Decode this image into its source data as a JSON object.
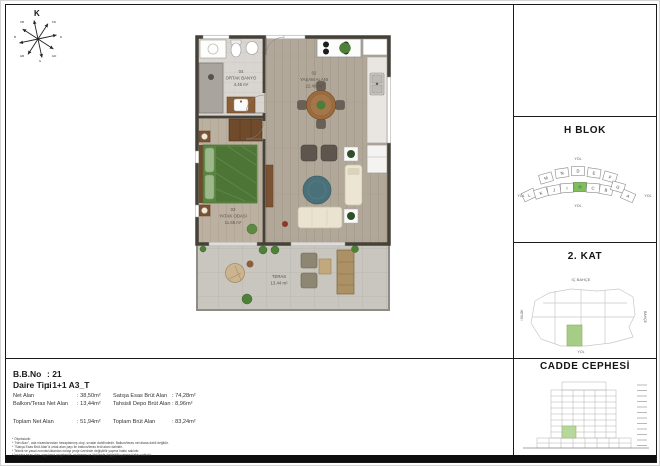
{
  "colors": {
    "site_green": "#7fbf5b",
    "kat_green": "#a6cd86",
    "facade_green": "#b7d79b",
    "bed_green": "#4c7536",
    "wall": "#454139"
  },
  "compass": {
    "north": "K",
    "dirs": {
      "kd": "KD",
      "d": "D",
      "gd": "GD",
      "g": "G",
      "gb": "GB",
      "b": "B",
      "kb": "KB"
    }
  },
  "plan": {
    "rooms": {
      "bathroom": {
        "no": "04",
        "name": "ORTAK BANYO",
        "area": "4.45 m²"
      },
      "living": {
        "no": "02",
        "name": "YAŞAM ALANI",
        "area": "22.40 m²"
      },
      "bedroom": {
        "no": "03",
        "name": "YATAK ODASI",
        "area": "11.65 m²"
      },
      "terrace": {
        "name": "TERAS",
        "area": "13.44 m²"
      }
    }
  },
  "sidebar": {
    "hblok": {
      "title": "H BLOK",
      "road": "YOL",
      "blocks": [
        {
          "label": "M"
        },
        {
          "label": "N"
        },
        {
          "label": "D"
        },
        {
          "label": "E"
        },
        {
          "label": "F"
        },
        {
          "label": "L"
        },
        {
          "label": "K"
        },
        {
          "label": "J"
        },
        {
          "label": "I"
        },
        {
          "label": "H"
        },
        {
          "label": "C"
        },
        {
          "label": "B"
        },
        {
          "label": "G"
        },
        {
          "label": "A"
        }
      ]
    },
    "kat": {
      "title": "2. KAT",
      "top": "İÇ BAHÇE",
      "left": "I BLOK",
      "right": "BAHÇE",
      "bottom": "YOL"
    },
    "facade": {
      "title": "CADDE CEPHESİ"
    }
  },
  "info": {
    "bbno": {
      "label": "B.B.No",
      "value": ": 21"
    },
    "daire": {
      "label": "Daire Tipi",
      "value": ": 1+1 A3_T"
    },
    "rows": [
      {
        "l1": "Net Alan",
        "v1": ": 38,50m²",
        "l2": "Satışa Esas Brüt Alan",
        "v2": ": 74,28m²"
      },
      {
        "l1": "Balkon/Teras Net Alan",
        "v1": ": 13,44m²",
        "l2": "Tahsisli Depo Brüt Alan",
        "v2": ": 8,96m²"
      }
    ],
    "totals": {
      "l1": "Toplam Net Alan",
      "v1": ": 51,94m²",
      "l2": "Toplam Brüt Alan",
      "v2": ": 83,24m²"
    },
    "disclaimers": [
      "*  Ölçeksizdir.",
      "*  \"Net Alan\", oda nizamlarından hesaplanmış olup, sıvalar dahilindedir. Balkon/teras net alana dahil değildir.",
      "*  \"Satışa Esas Brüt Alan\"a ortak alan payı ile balkon/teras brüt alanı dahildir.",
      "*  Teknik ve yasal zorunluluklardan dolayı proje üzerinde değişiklik yapma hakkı saklıdır.",
      "*  İnşaata esas olan uygulama projeleridir; malzeme ve ölçülerde değişiklik yapma hakkı saklıdır."
    ]
  }
}
